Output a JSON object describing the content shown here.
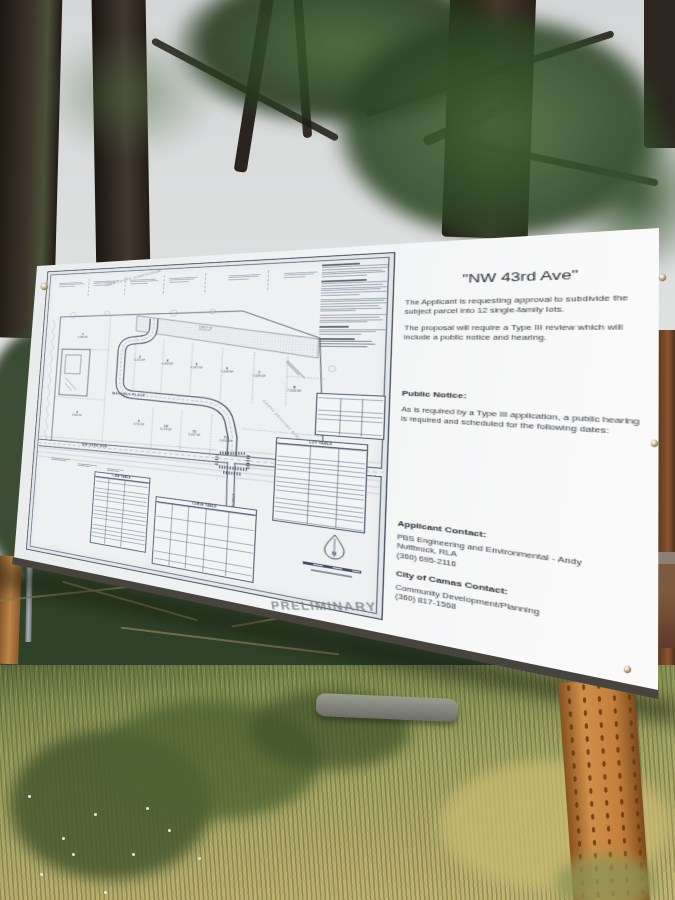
{
  "sign": {
    "heading": "\"NW 43rd Ave\"",
    "intro_paragraphs": [
      "The Applicant is requesting approval to subdivide the subject parcel into 12 single-family lots.",
      "The proposal will require a Type III review which will include a public notice and hearing."
    ],
    "public_notice": {
      "title": "Public Notice:",
      "body": "As is required by a Type III application, a public hearing is required and scheduled for the following dates:"
    },
    "applicant_contact": {
      "title": "Applicant Contact:",
      "lines": [
        "PBS Engineering and Environmental - Andy",
        "Nuttbrock, RLA",
        "(360) 695-2116"
      ]
    },
    "city_contact": {
      "title": "City of Camas Contact:",
      "lines": [
        "Community Development/Planning",
        "(360) 817-1568"
      ]
    }
  },
  "site_plan": {
    "stamp": "PRELIMINARY",
    "streets": {
      "waverly_place": "WAVERLY PLACE",
      "nw_43rd_ave": "NW 43RD AVE",
      "utah_street": "UTAH STREET"
    },
    "labels": {
      "lake_pointe": "LAKE POINTE SUBDIVISION",
      "sierra_meadows": "SIERRA MEADOWS SUBDIVISION",
      "tract_b": "TRACT 'B'",
      "tract_b_area": "18,230 SF"
    },
    "tables": {
      "lot_table": "LOT TABLE",
      "line_table": "LINE TABLE",
      "curve_table": "CURVE TABLE"
    },
    "north_letter": "N",
    "lots": [
      {
        "num": "1",
        "sf": "5,583 SF"
      },
      {
        "num": "2",
        "sf": "5,003 SF"
      },
      {
        "num": "3",
        "sf": "5,250 SF"
      },
      {
        "num": "4",
        "sf": "5,000 SF"
      },
      {
        "num": "5",
        "sf": "5,437 SF"
      },
      {
        "num": "6",
        "sf": "7,438 SF"
      },
      {
        "num": "7",
        "sf": "7,439 SF"
      },
      {
        "num": "8",
        "sf": "7,528 SF"
      },
      {
        "num": "9",
        "sf": "4,750 SF"
      },
      {
        "num": "10",
        "sf": "5,178 SF"
      },
      {
        "num": "11",
        "sf": "5,057 SF"
      },
      {
        "num": "12",
        "sf": "5,602 SF"
      }
    ]
  },
  "colors": {
    "board": "#f2f3f4",
    "plan_ink": "#3e4c60",
    "wood_post": "#c6873f",
    "stamp_gray": "#8a8f94"
  }
}
